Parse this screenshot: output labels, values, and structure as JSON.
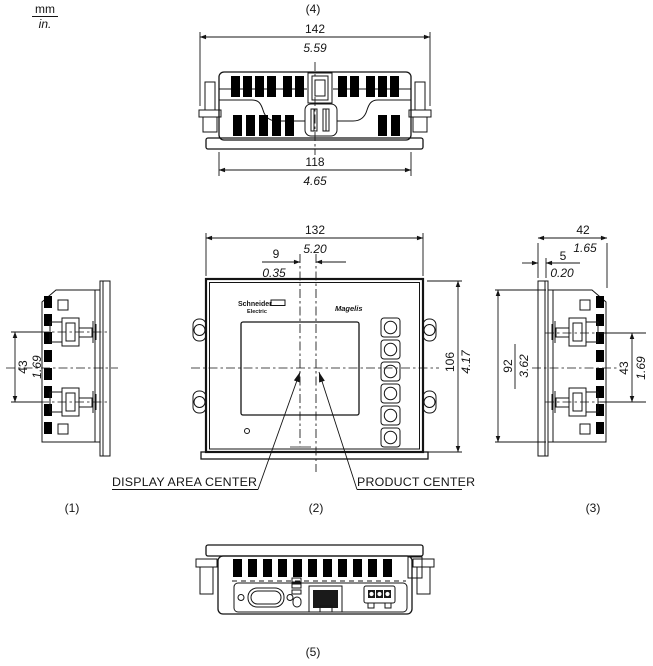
{
  "units": {
    "mm_label": "mm",
    "inch_label": "in."
  },
  "brand": {
    "manufacturer_line1": "Schneider",
    "manufacturer_line2": "Electric",
    "product_name": "Magelis"
  },
  "annotations": {
    "display_area_center": "DISPLAY AREA CENTER",
    "product_center": "PRODUCT CENTER"
  },
  "views": {
    "top": {
      "tag": "(4)",
      "overall_width": {
        "mm": "142",
        "inch": "5.59"
      },
      "body_width": {
        "mm": "118",
        "inch": "4.65"
      }
    },
    "front": {
      "tag": "(2)",
      "bezel_width": {
        "mm": "132",
        "inch": "5.20"
      },
      "center_offset": {
        "mm": "9",
        "inch": "0.35"
      },
      "bezel_height": {
        "mm": "106",
        "inch": "4.17"
      }
    },
    "left": {
      "tag": "(1)",
      "clamp_spacing": {
        "mm": "43",
        "inch": "1.69"
      }
    },
    "right": {
      "tag": "(3)",
      "overall_depth": {
        "mm": "42",
        "inch": "1.65"
      },
      "bezel_depth": {
        "mm": "5",
        "inch": "0.20"
      },
      "body_height": {
        "mm": "92",
        "inch": "3.62"
      },
      "clamp_spacing": {
        "mm": "43",
        "inch": "1.69"
      }
    },
    "bottom": {
      "tag": "(5)"
    }
  },
  "colors": {
    "line": "#141414",
    "background": "#ffffff"
  }
}
